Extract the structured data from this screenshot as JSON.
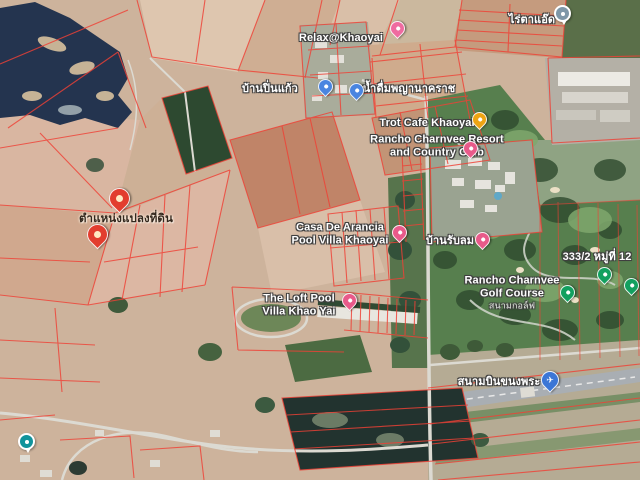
{
  "view": {
    "type": "satellite-map",
    "area": "Khao Yai / Khanong Phra"
  },
  "map_colors": {
    "field_tan": "#cdb39c",
    "field_pink": "#dab5a0",
    "field_red": "#c08468",
    "golf_green": "#577f4e",
    "forest_green": "#2d4930",
    "water_dark": "#24344f",
    "parcel_line_red": "#ef4136",
    "road_gray": "#dcdad2",
    "lodging_pink": "#e85a8a",
    "shop_blue": "#4a85e0",
    "cafe_yellow": "#eda413",
    "golf_marker_green": "#12a05f",
    "plot_marker_red": "#e23d2e"
  },
  "labels": [
    {
      "name": "label-rai-ta-aed",
      "lines": [
        "ไร่ตาแอ๊ด"
      ],
      "x": 532,
      "y": 20,
      "style": "light"
    },
    {
      "name": "label-relax-khaoyai",
      "lines": [
        "Relax@Khaoyai"
      ],
      "x": 341,
      "y": 38,
      "style": "light"
    },
    {
      "name": "label-ban-pin-kaew",
      "lines": [
        "บ้านปิ่นแก้ว"
      ],
      "x": 270,
      "y": 89,
      "style": "light"
    },
    {
      "name": "label-nam-duem-phaya-nakharat",
      "lines": [
        "น้ำดื่มพญานาคราช"
      ],
      "x": 409,
      "y": 89,
      "style": "light"
    },
    {
      "name": "label-trot-cafe-khaoyai",
      "lines": [
        "Trot Cafe Khaoyai"
      ],
      "x": 427,
      "y": 123,
      "style": "light"
    },
    {
      "name": "label-rancho-charnvee-resort",
      "lines": [
        "Rancho Charnvee Resort",
        "and Country Club"
      ],
      "x": 437,
      "y": 146,
      "style": "light"
    },
    {
      "name": "label-plot-location",
      "lines": [
        "ตำแหน่งแปลงที่ดิน"
      ],
      "x": 126,
      "y": 219,
      "style": "dark"
    },
    {
      "name": "label-casa-de-arancia",
      "lines": [
        "Casa De Arancia",
        "Pool Villa Khaoyai"
      ],
      "x": 340,
      "y": 234,
      "style": "light"
    },
    {
      "name": "label-ban-rub-lom",
      "lines": [
        "บ้านรับลม"
      ],
      "x": 450,
      "y": 241,
      "style": "light"
    },
    {
      "name": "label-address-333-2",
      "lines": [
        "333/2 หมู่ที่ 12"
      ],
      "x": 597,
      "y": 257,
      "style": "light"
    },
    {
      "name": "label-rancho-charnvee-golf-course",
      "lines": [
        "Rancho Charnvee",
        "Golf Course"
      ],
      "sub": "สนามกอล์ฟ",
      "x": 512,
      "y": 293,
      "style": "light"
    },
    {
      "name": "label-the-loft-pool-villa",
      "lines": [
        "The Loft Pool",
        "Villa Khao Yai"
      ],
      "x": 299,
      "y": 305,
      "style": "light"
    },
    {
      "name": "label-khanong-phra-airfield",
      "lines": [
        "สนามบินขนงพระ"
      ],
      "x": 499,
      "y": 382,
      "style": "light"
    }
  ],
  "markers": [
    {
      "name": "marker-rai-ta-aed",
      "type": "circle",
      "color": "#7e97a8",
      "x": 561,
      "y": 22
    },
    {
      "name": "marker-relax-khaoyai",
      "type": "pin",
      "color": "#ef6ba0",
      "x": 397,
      "y": 37
    },
    {
      "name": "marker-ban-pin-kaew",
      "type": "pin",
      "color": "#4a85e0",
      "x": 325,
      "y": 95
    },
    {
      "name": "marker-nam-duem",
      "type": "pin",
      "color": "#4a85e0",
      "x": 356,
      "y": 99
    },
    {
      "name": "marker-trot-cafe",
      "type": "pin",
      "color": "#eda413",
      "x": 479,
      "y": 128
    },
    {
      "name": "marker-rancho-resort",
      "type": "pin",
      "color": "#e85a8a",
      "x": 470,
      "y": 157
    },
    {
      "name": "marker-plot-1",
      "type": "red-pin",
      "color": "#e23d2e",
      "x": 119,
      "y": 212
    },
    {
      "name": "marker-plot-2",
      "type": "red-pin",
      "color": "#e23d2e",
      "x": 97,
      "y": 248
    },
    {
      "name": "marker-casa-de-arancia",
      "type": "pin",
      "color": "#e85a8a",
      "x": 399,
      "y": 241
    },
    {
      "name": "marker-ban-rub-lom",
      "type": "pin",
      "color": "#e85a8a",
      "x": 482,
      "y": 248
    },
    {
      "name": "marker-address-333-2",
      "type": "pin",
      "color": "#12a05f",
      "x": 604,
      "y": 283
    },
    {
      "name": "marker-golf-course",
      "type": "pin",
      "color": "#12a05f",
      "x": 567,
      "y": 301
    },
    {
      "name": "marker-golf-course-2",
      "type": "pin",
      "color": "#12a05f",
      "x": 631,
      "y": 294
    },
    {
      "name": "marker-the-loft",
      "type": "pin",
      "color": "#e85a8a",
      "x": 349,
      "y": 309
    },
    {
      "name": "marker-airfield",
      "type": "plane-pin",
      "color": "#3b76d6",
      "x": 549,
      "y": 391,
      "glyph": "✈"
    },
    {
      "name": "marker-lodging-sw",
      "type": "circle",
      "color": "#11939b",
      "x": 25,
      "y": 450
    }
  ]
}
